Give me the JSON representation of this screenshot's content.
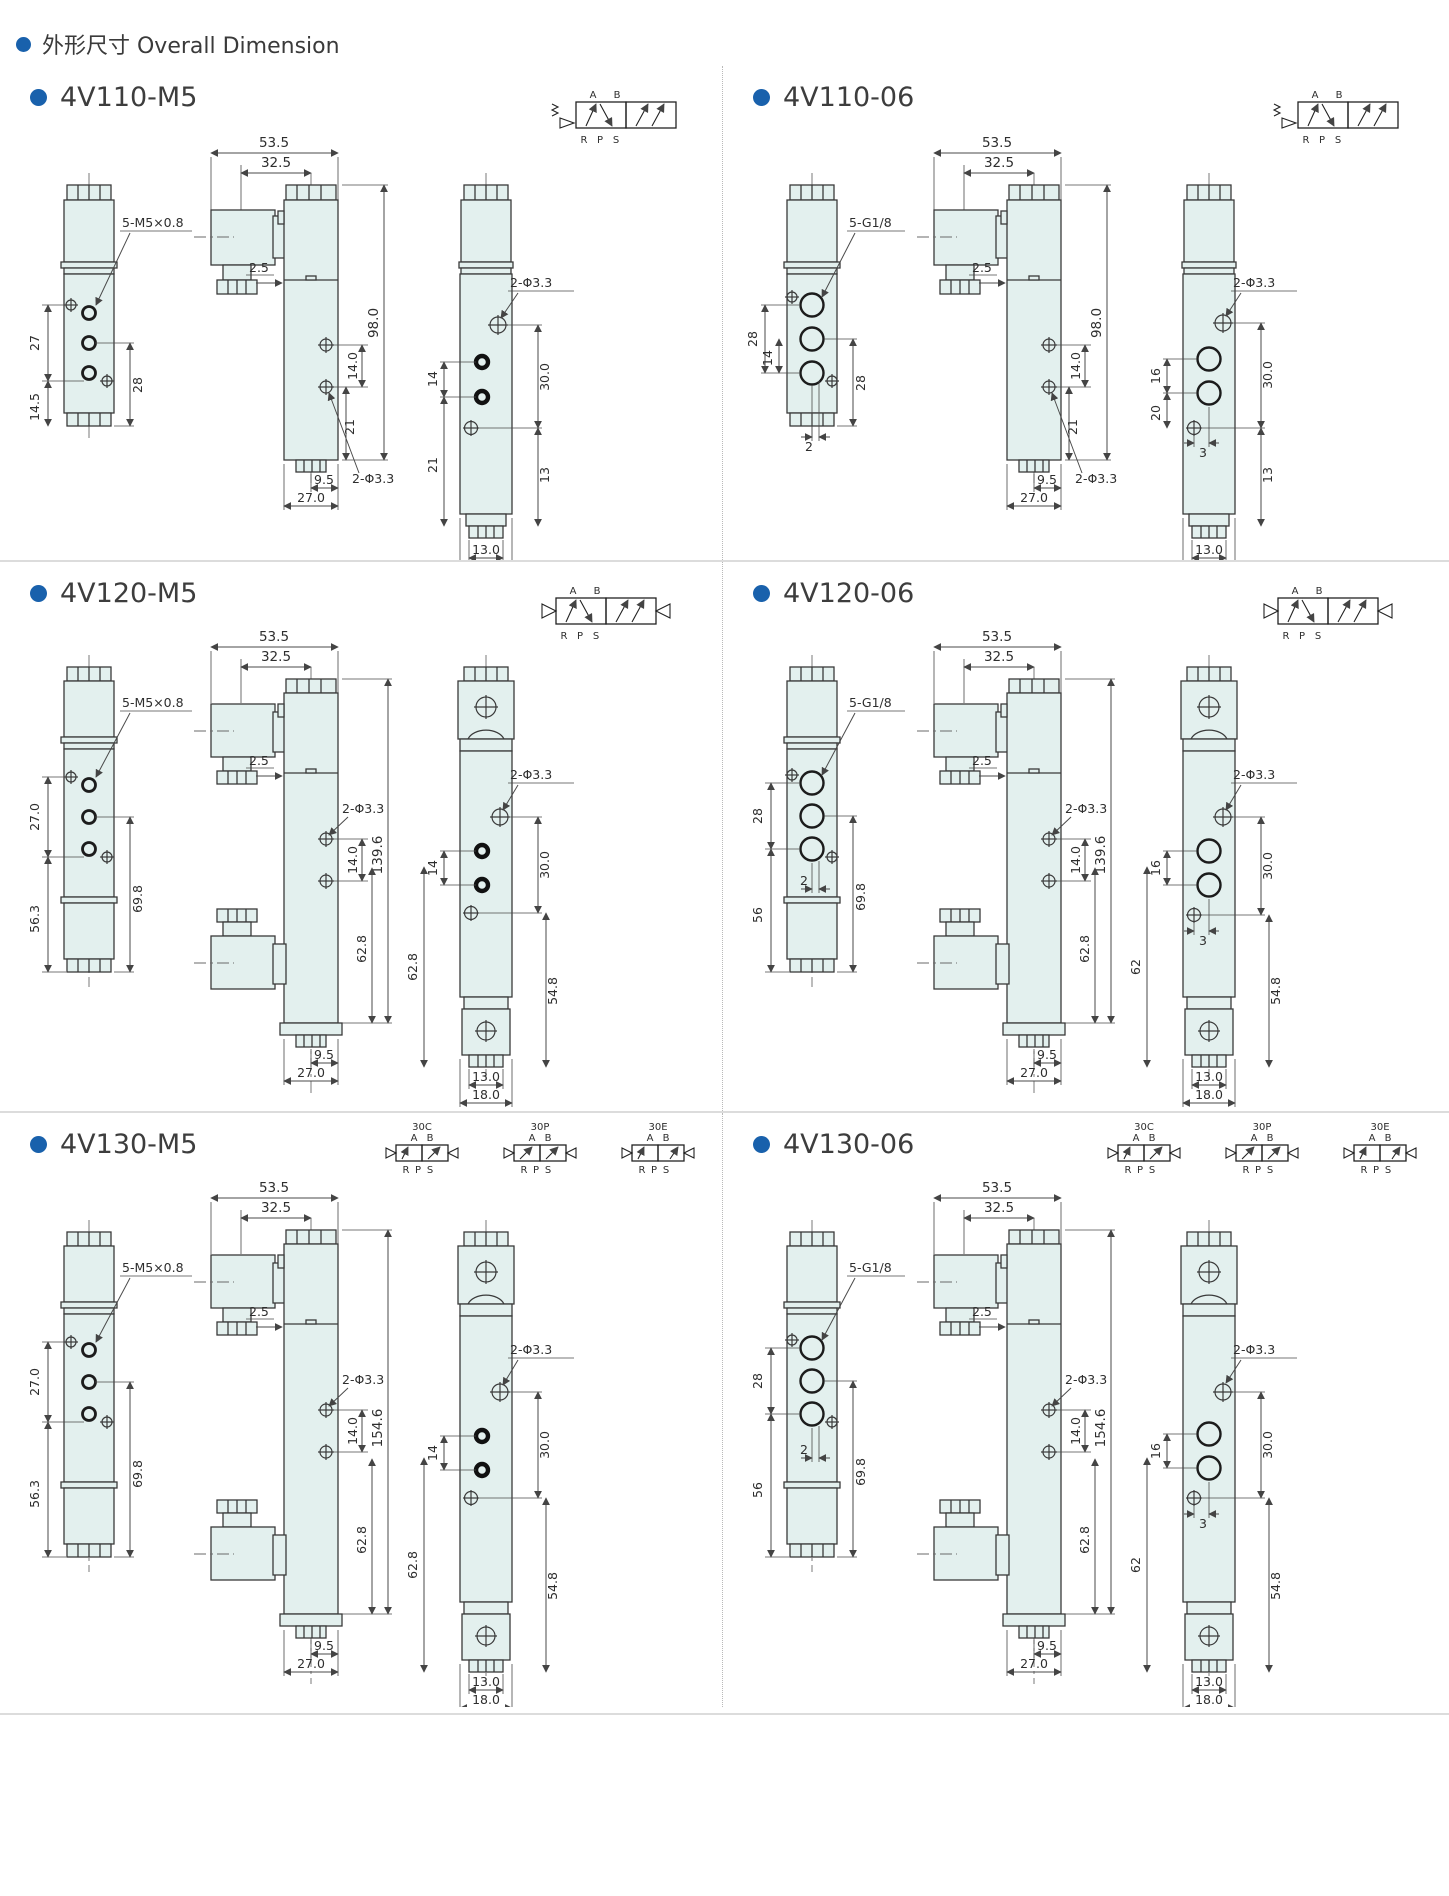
{
  "header": {
    "title": "外形尺寸 Overall Dimension"
  },
  "sym": {
    "a": "A",
    "b": "B",
    "r": "R",
    "p": "P",
    "s": "S"
  },
  "panels": {
    "p110m5": {
      "title": "4V110-M5",
      "left": {
        "thread": "5-M5×0.8",
        "d27": "27",
        "d145": "14.5",
        "d28": "28"
      },
      "front": {
        "w1": "53.5",
        "w2": "32.5",
        "off": "2.5",
        "h": "98.0",
        "p1": "14.0",
        "p2": "21",
        "phi": "2-Φ3.3",
        "b1": "9.5",
        "b2": "27.0"
      },
      "side": {
        "phi": "2-Φ3.3",
        "s1": "14",
        "s2": "21",
        "s3": "30.0",
        "s4": "13",
        "b1": "13.0",
        "b2": "18.0"
      }
    },
    "p110o6": {
      "title": "4V110-06",
      "left": {
        "thread": "5-G1/8",
        "d28a": "28",
        "d14": "14",
        "d2": "2",
        "d28b": "28"
      },
      "front": {
        "w1": "53.5",
        "w2": "32.5",
        "off": "2.5",
        "h": "98.0",
        "p1": "14.0",
        "p2": "21",
        "phi": "2-Φ3.3",
        "b1": "9.5",
        "b2": "27.0"
      },
      "side": {
        "phi": "2-Φ3.3",
        "s1": "16",
        "s2": "20",
        "s3": "3",
        "s4": "30.0",
        "s5": "13",
        "b1": "13.0",
        "b2": "18.0"
      }
    },
    "p120m5": {
      "title": "4V120-M5",
      "left": {
        "thread": "5-M5×0.8",
        "d270": "27.0",
        "d563": "56.3",
        "d698": "69.8"
      },
      "front": {
        "w1": "53.5",
        "w2": "32.5",
        "off": "2.5",
        "phi": "2-Φ3.3",
        "p1": "14.0",
        "h": "139.6",
        "hb": "62.8",
        "b1": "9.5",
        "b2": "27.0"
      },
      "side": {
        "phi": "2-Φ3.3",
        "s1": "14",
        "s2": "30.0",
        "hl": "62.8",
        "hr": "54.8",
        "b1": "13.0",
        "b2": "18.0"
      }
    },
    "p120o6": {
      "title": "4V120-06",
      "left": {
        "thread": "5-G1/8",
        "d28": "28",
        "d2": "2",
        "d56": "56",
        "d698": "69.8"
      },
      "front": {
        "w1": "53.5",
        "w2": "32.5",
        "off": "2.5",
        "phi": "2-Φ3.3",
        "p1": "14.0",
        "h": "139.6",
        "hb": "62.8",
        "b1": "9.5",
        "b2": "27.0"
      },
      "side": {
        "phi": "2-Φ3.3",
        "s1": "16",
        "s2": "3",
        "s3": "30.0",
        "hl": "62",
        "hr": "54.8",
        "b1": "13.0",
        "b2": "18.0"
      }
    },
    "p130m5": {
      "title": "4V130-M5",
      "tags": {
        "c": "30C",
        "p": "30P",
        "e": "30E"
      },
      "left": {
        "thread": "5-M5×0.8",
        "d270": "27.0",
        "d563": "56.3",
        "d698": "69.8"
      },
      "front": {
        "w1": "53.5",
        "w2": "32.5",
        "off": "2.5",
        "phi": "2-Φ3.3",
        "p1": "14.0",
        "h": "154.6",
        "hb": "62.8",
        "b1": "9.5",
        "b2": "27.0"
      },
      "side": {
        "phi": "2-Φ3.3",
        "s1": "14",
        "s2": "30.0",
        "hl": "62.8",
        "hr": "54.8",
        "b1": "13.0",
        "b2": "18.0"
      }
    },
    "p130o6": {
      "title": "4V130-06",
      "tags": {
        "c": "30C",
        "p": "30P",
        "e": "30E"
      },
      "left": {
        "thread": "5-G1/8",
        "d28": "28",
        "d2": "2",
        "d56": "56",
        "d698": "69.8"
      },
      "front": {
        "w1": "53.5",
        "w2": "32.5",
        "off": "2.5",
        "phi": "2-Φ3.3",
        "p1": "14.0",
        "h": "154.6",
        "hb": "62.8",
        "b1": "9.5",
        "b2": "27.0"
      },
      "side": {
        "phi": "2-Φ3.3",
        "s1": "16",
        "s2": "3",
        "s3": "30.0",
        "hl": "62",
        "hr": "54.8",
        "b1": "13.0",
        "b2": "18.0"
      }
    }
  }
}
